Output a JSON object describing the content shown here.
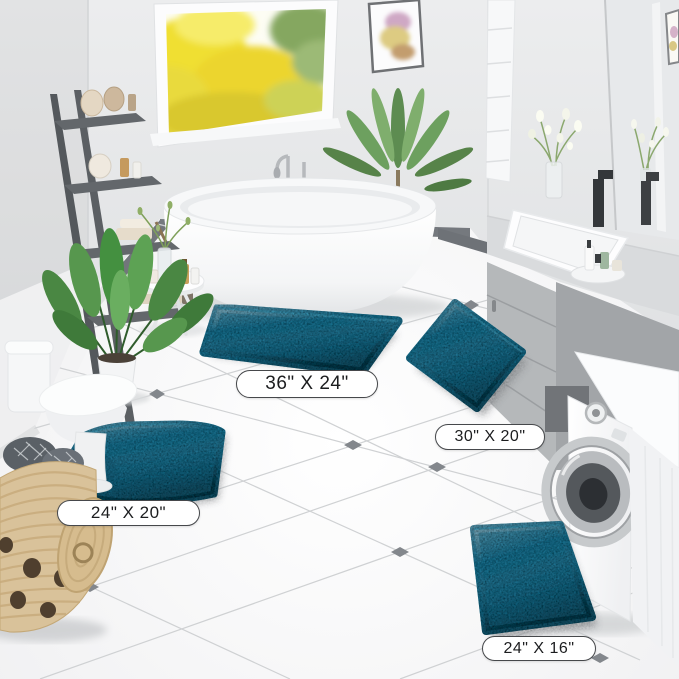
{
  "product_labels": {
    "mat_36x24": "36\" X 24\"",
    "mat_30x20": "30\" X 20\"",
    "mat_24x20": "24\" X 20\"",
    "mat_24x16": "24\" X 16\""
  },
  "colors": {
    "mat_teal": "#1b7292",
    "wall_gray": "#e9eaec",
    "floor_white": "#f8f8f9",
    "tile_accent_gray": "#83878c",
    "baseboard_gray": "#72767b",
    "vanity_gray": "#abaeb1",
    "ladder_gray": "#565a5e",
    "basket_tan": "#d9c29a"
  },
  "scene_objects": {
    "window": "window-with-yellow-trees",
    "wall_art": "flower-watercolor-frame",
    "bathtub": "freestanding-white-tub",
    "toilet": "white-toilet",
    "vanity": "gray-vanity-with-sink",
    "washer": "white-washing-machine",
    "basket": "woven-laundry-basket"
  }
}
